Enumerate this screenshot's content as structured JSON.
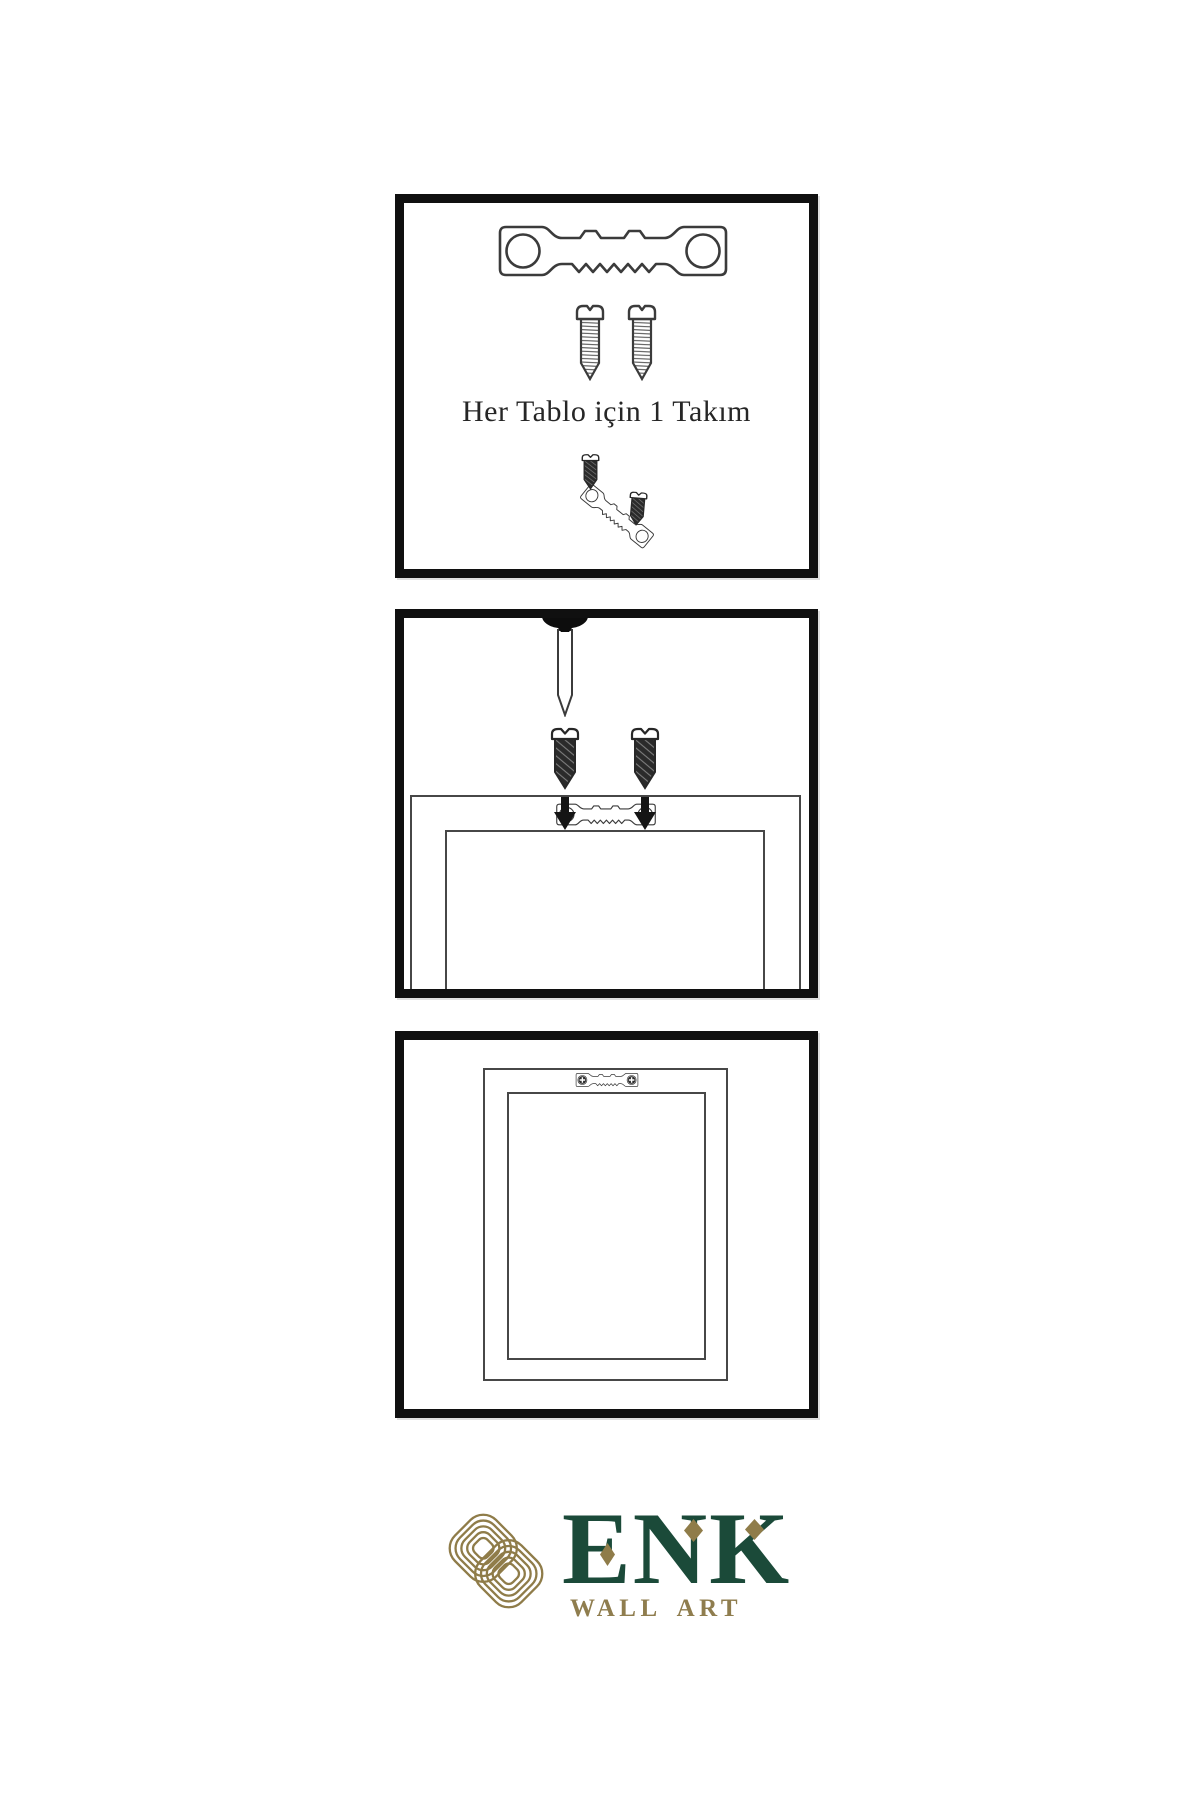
{
  "document": {
    "kind": "wall-art hanging instructions sheet",
    "background": "#ffffff"
  },
  "panels": [
    {
      "id": "hardware-kit",
      "caption": "Her Tablo için 1 Takım",
      "contents": [
        "sawtooth-hanger-plate",
        "two-screws",
        "screw-driven-into-tilted-hanger"
      ]
    },
    {
      "id": "attach-hanger-to-frame",
      "contents": [
        "nail-in-wall",
        "two-screws-with-down-arrows",
        "frame-back-with-sawtooth-hanger"
      ]
    },
    {
      "id": "frame-mounted",
      "contents": [
        "frame-back-with-hanger-screwed-on"
      ]
    }
  ],
  "brand": {
    "name": "ENK",
    "tagline": "WALL ART"
  },
  "colors": {
    "brand_green": "#1b4a39",
    "brand_gold": "#8f7c49",
    "panel_border": "#101010",
    "line_art": "#3b3b3b"
  }
}
